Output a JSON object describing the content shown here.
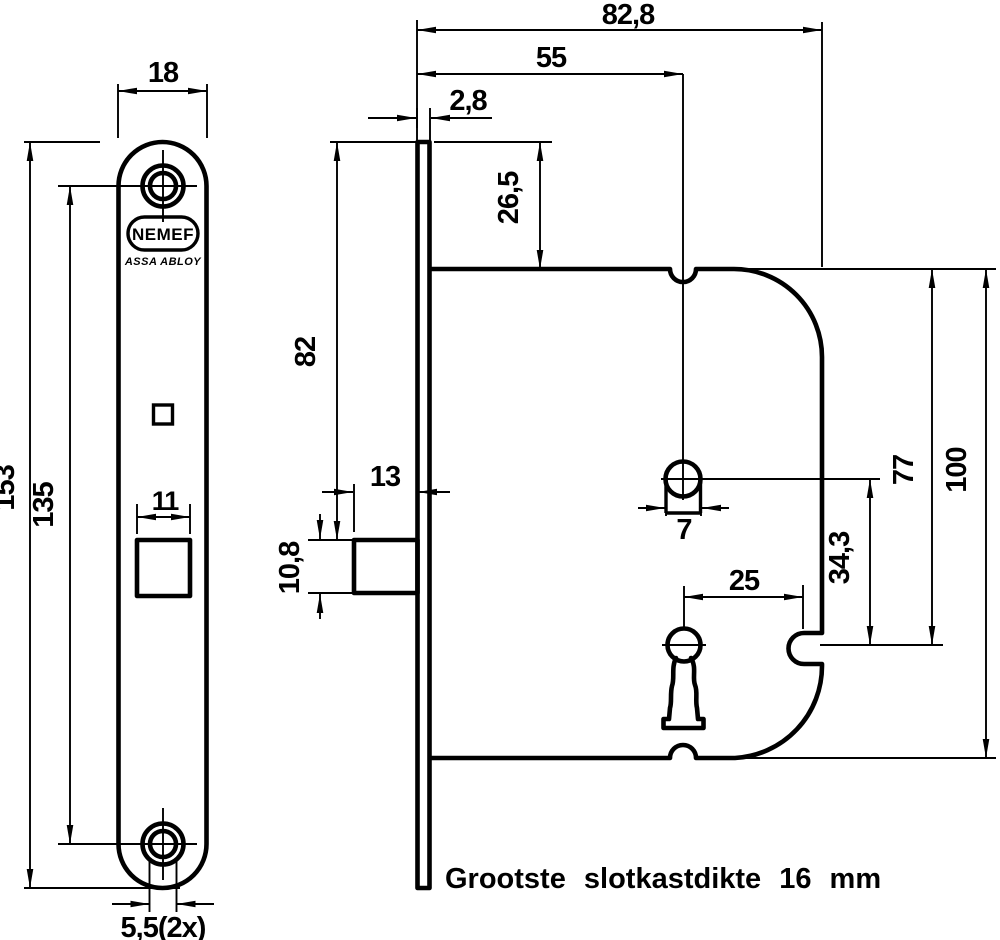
{
  "title": "NEMEF mortise lock technical drawing",
  "note": "Grootste slotkastdikte 16 mm",
  "logo": {
    "brand": "NEMEF",
    "subbrand": "ASSA ABLOY"
  },
  "front_view": {
    "plate_width": "18",
    "plate_height": "153",
    "screw_spacing": "135",
    "bolt_width": "11",
    "screw_diameter": "5,5(2x)"
  },
  "side_view": {
    "overall_depth": "82,8",
    "backset": "55",
    "faceplate_thickness": "2,8",
    "top_offset": "26,5",
    "plate_top_to_bolt": "82",
    "bolt_protrusion": "13",
    "bolt_height": "10,8",
    "follower_hole": "7",
    "keyhole_to_fixing": "25",
    "follower_to_keyhole": "34,3",
    "keyhole_from_top": "77",
    "case_height": "100"
  },
  "colors": {
    "line": "#000000",
    "background": "#ffffff"
  }
}
